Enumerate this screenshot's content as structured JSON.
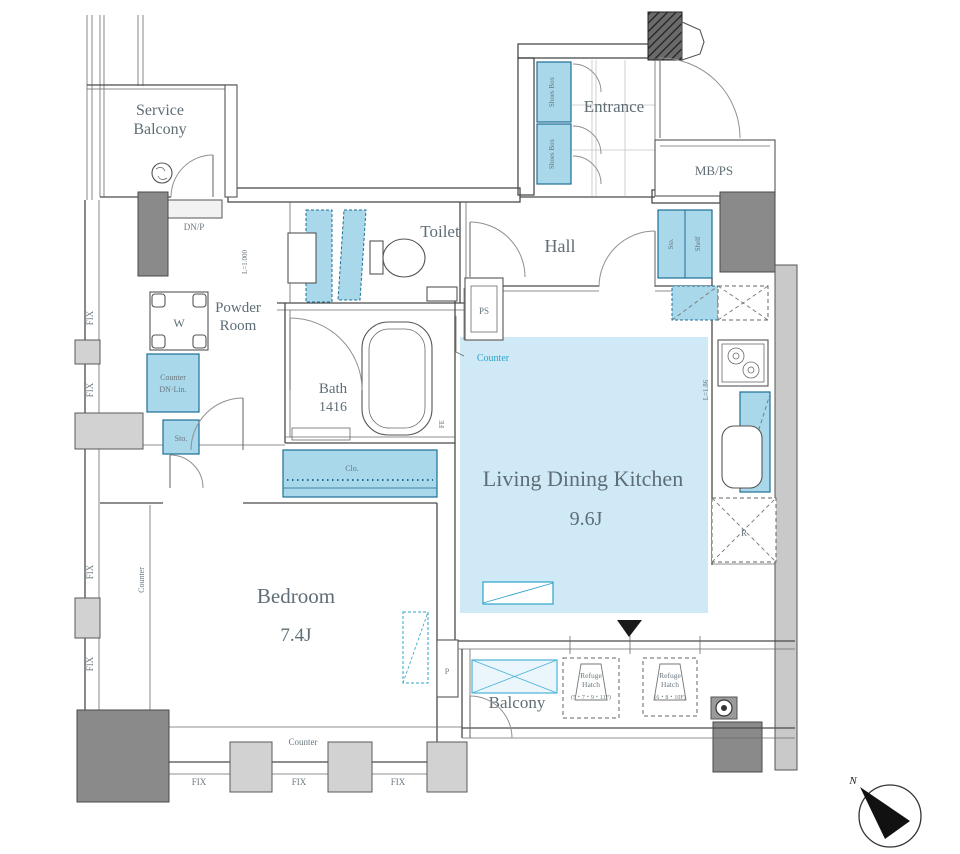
{
  "plan_type": "apartment-floor-plan",
  "colors": {
    "fixture_fill": "#a8d8ea",
    "fixture_stroke": "#1f6d96",
    "floor_highlight": "#cfe9f7",
    "accent_text": "#2fa3c9",
    "wall": "#4a4a4a",
    "pillar": "#8a8a8a"
  },
  "labels": {
    "service_balcony_1": "Service",
    "service_balcony_2": "Balcony",
    "dn_p": "DN/P",
    "entrance": "Entrance",
    "shoes_box_upper": "Shoes Box",
    "shoes_box_lower": "Shoes Box",
    "mb_ps": "MB/PS",
    "toilet": "Toilet",
    "l_1000": "L=1.000",
    "hall": "Hall",
    "powder_1": "Powder",
    "powder_2": "Room",
    "washer": "W",
    "counter_dn_1": "Counter",
    "counter_dn_2": "DN·Lin.",
    "sto_small": "Sto.",
    "sto": "Sto.",
    "shelf": "Shelf",
    "ps": "PS",
    "counter_kitchen": "Counter",
    "bath": "Bath",
    "bath_size": "1416",
    "clo": "Clo.",
    "fe": "FE",
    "ldk": "Living Dining Kitchen",
    "ldk_size": "9.6J",
    "l_186": "L=1.86",
    "fridge": "R",
    "bedroom": "Bedroom",
    "bedroom_size": "7.4J",
    "counter_left": "Counter",
    "counter_bottom": "Counter",
    "p": "P",
    "balcony": "Balcony",
    "refuge_1_1": "Refuge",
    "refuge_1_2": "Hatch",
    "refuge_1_3": "(5・7・9・11F)",
    "refuge_2_1": "Refuge",
    "refuge_2_2": "Hatch",
    "refuge_2_3": "(6・8・10F)",
    "fix": "FIX",
    "north": "N"
  }
}
